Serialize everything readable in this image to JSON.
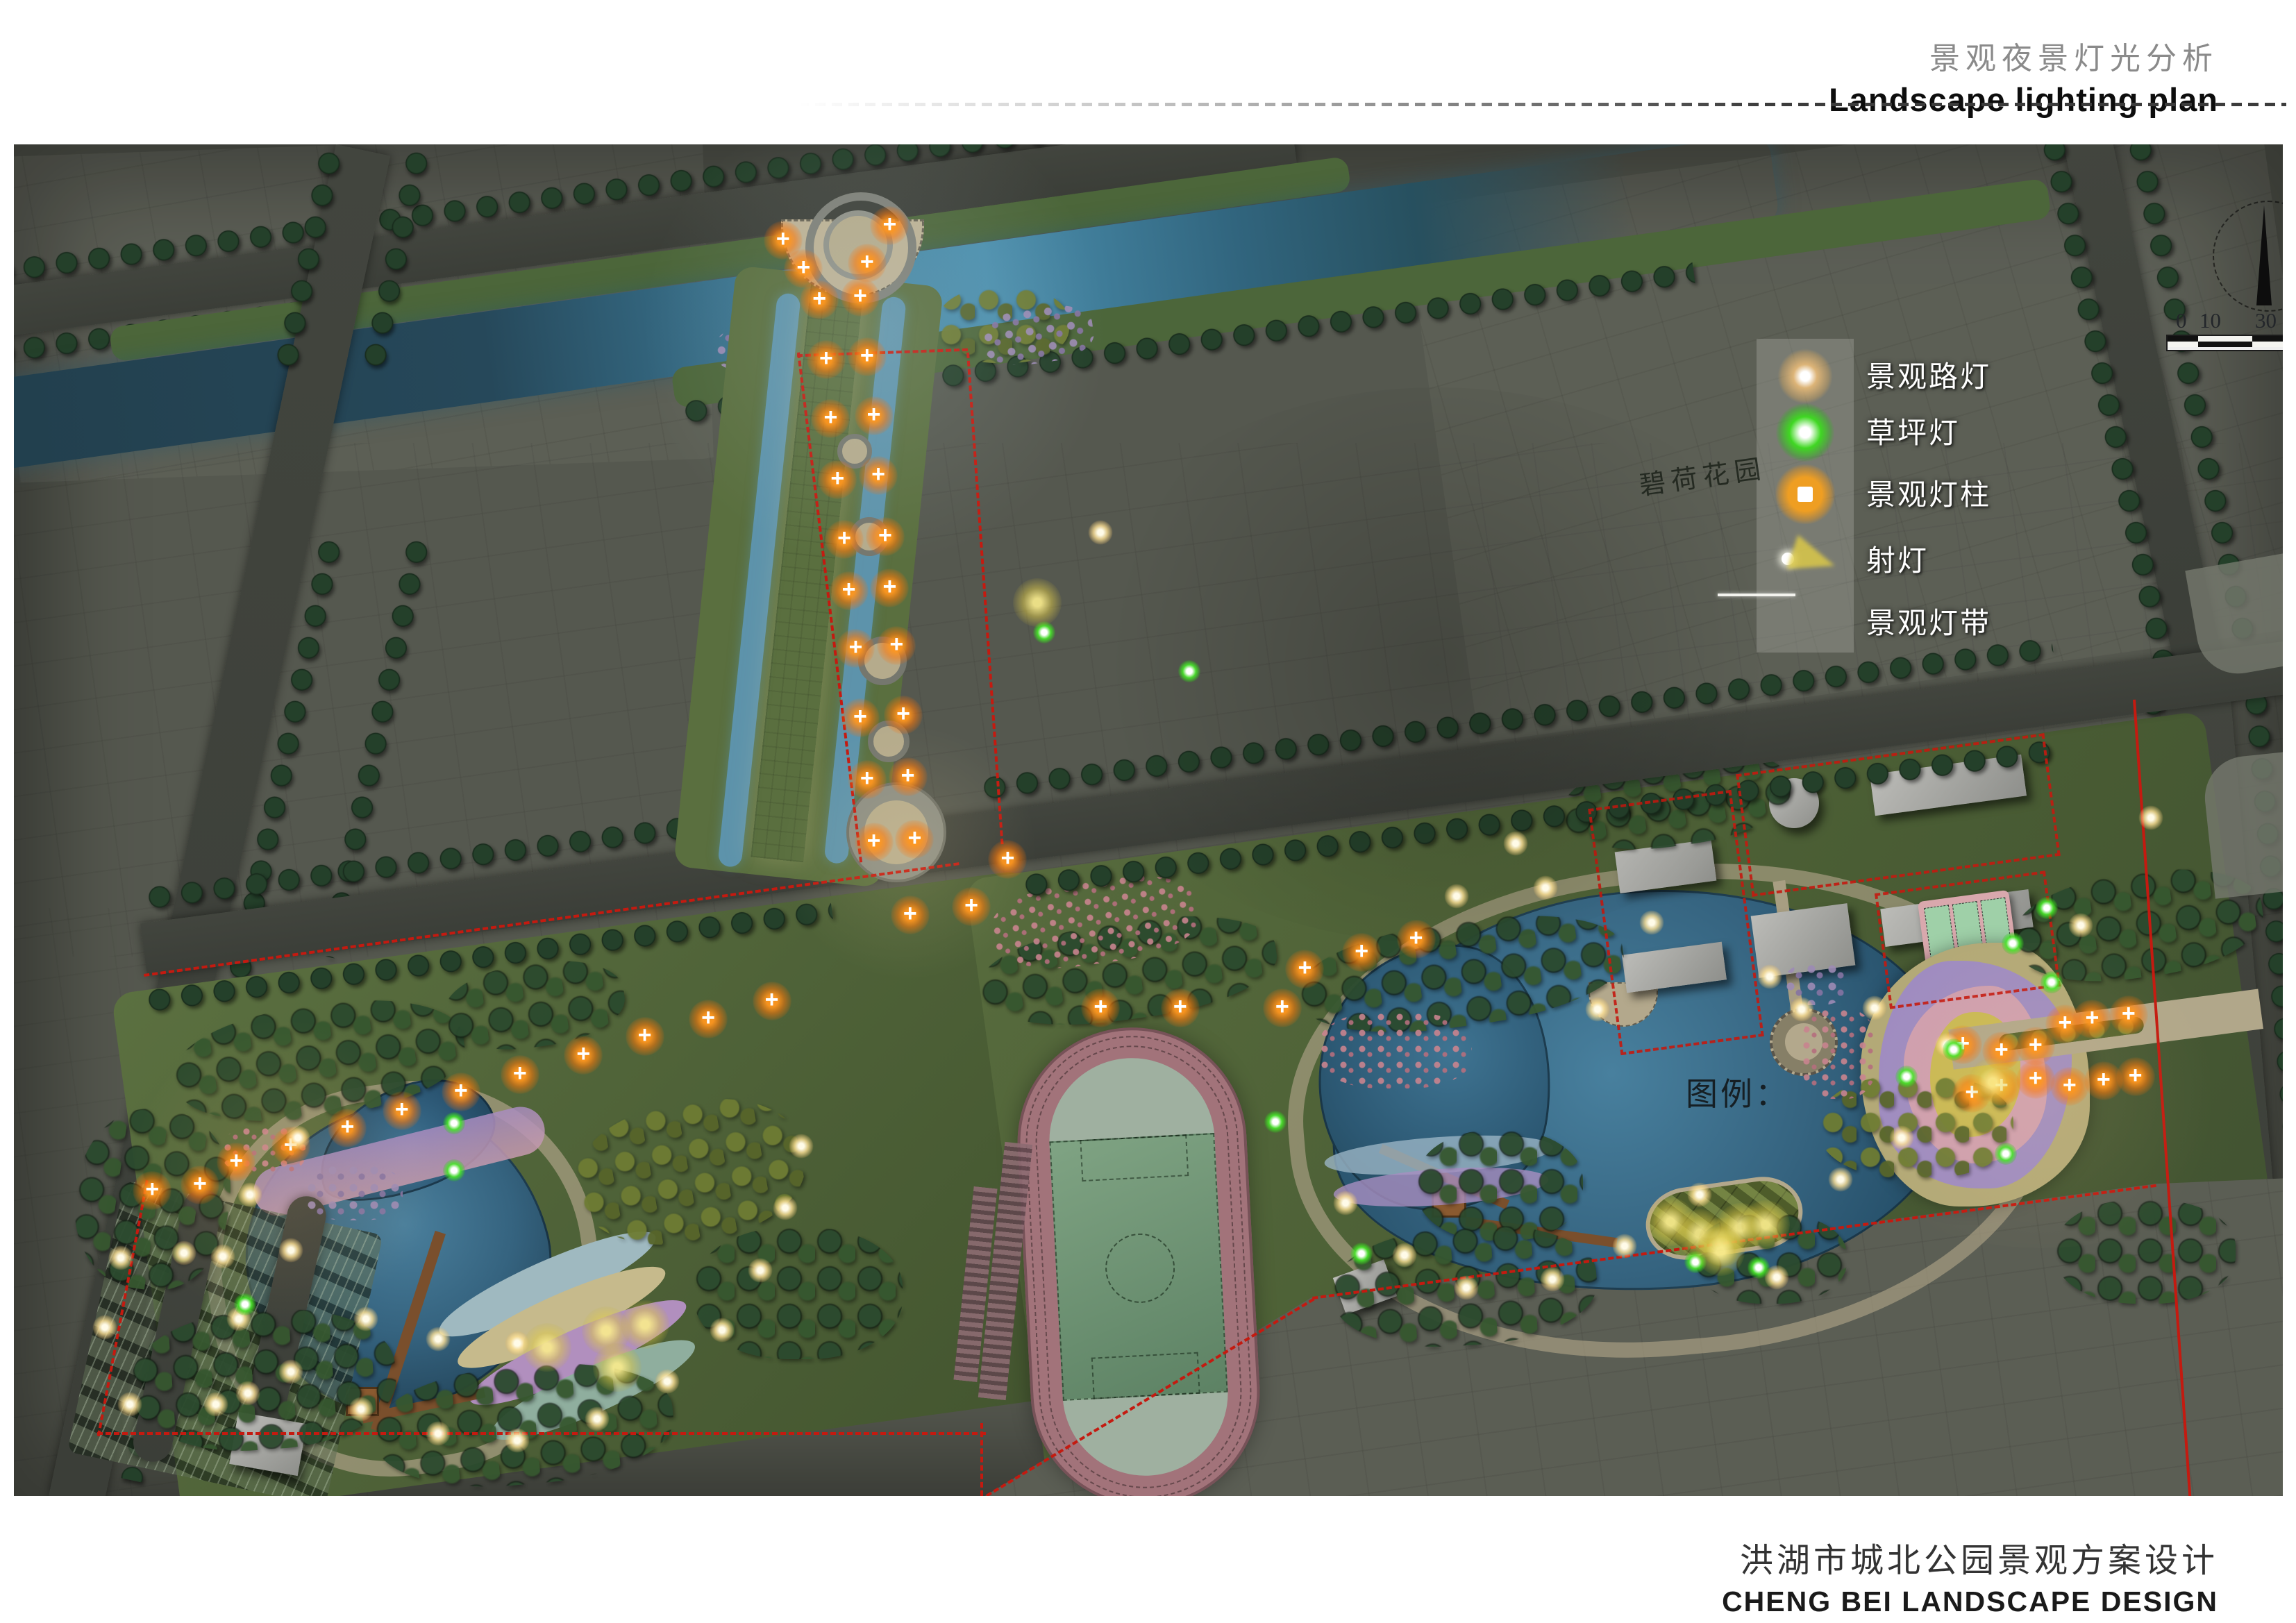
{
  "header": {
    "title_cn": "景观夜景灯光分析",
    "title_en": "Landscape lighting plan"
  },
  "footer": {
    "title_cn": "洪湖市城北公园景观方案设计",
    "title_en": "CHENG BEI  LANDSCAPE DESIGN"
  },
  "legend": {
    "pointer_label": "图例：",
    "items": [
      {
        "symbol": "road-light",
        "label": "景观路灯"
      },
      {
        "symbol": "lawn-light",
        "label": "草坪灯"
      },
      {
        "symbol": "light-column",
        "label": "景观灯柱"
      },
      {
        "symbol": "spot-light",
        "label": "射灯"
      },
      {
        "symbol": "light-strip",
        "label": "景观灯带"
      }
    ]
  },
  "map": {
    "estate_label": "碧荷花园",
    "scale_bar": {
      "labels": [
        "0",
        "10",
        "30"
      ]
    },
    "lights": [
      {
        "t": "o",
        "x": 33.9,
        "y": 7.1
      },
      {
        "t": "o",
        "x": 38.6,
        "y": 6.0
      },
      {
        "t": "o",
        "x": 34.8,
        "y": 9.2
      },
      {
        "t": "o",
        "x": 37.6,
        "y": 8.8
      },
      {
        "t": "o",
        "x": 35.5,
        "y": 11.5
      },
      {
        "t": "o",
        "x": 37.3,
        "y": 11.3
      },
      {
        "t": "o",
        "x": 35.8,
        "y": 15.9
      },
      {
        "t": "o",
        "x": 37.6,
        "y": 15.7
      },
      {
        "t": "o",
        "x": 36.0,
        "y": 20.3
      },
      {
        "t": "o",
        "x": 37.9,
        "y": 20.1
      },
      {
        "t": "o",
        "x": 36.3,
        "y": 24.8
      },
      {
        "t": "o",
        "x": 38.1,
        "y": 24.5
      },
      {
        "t": "o",
        "x": 36.6,
        "y": 29.2
      },
      {
        "t": "o",
        "x": 38.4,
        "y": 29.0
      },
      {
        "t": "o",
        "x": 36.8,
        "y": 33.0
      },
      {
        "t": "o",
        "x": 38.6,
        "y": 32.8
      },
      {
        "t": "o",
        "x": 37.1,
        "y": 37.3
      },
      {
        "t": "o",
        "x": 38.9,
        "y": 37.1
      },
      {
        "t": "o",
        "x": 37.3,
        "y": 42.4
      },
      {
        "t": "o",
        "x": 39.2,
        "y": 42.2
      },
      {
        "t": "o",
        "x": 37.6,
        "y": 47.0
      },
      {
        "t": "o",
        "x": 39.4,
        "y": 46.8
      },
      {
        "t": "o",
        "x": 37.9,
        "y": 51.6
      },
      {
        "t": "o",
        "x": 39.7,
        "y": 51.4
      },
      {
        "t": "o",
        "x": 39.5,
        "y": 57.0
      },
      {
        "t": "o",
        "x": 42.2,
        "y": 56.4
      },
      {
        "t": "o",
        "x": 43.8,
        "y": 52.9
      },
      {
        "t": "o",
        "x": 9.8,
        "y": 75.3
      },
      {
        "t": "o",
        "x": 12.2,
        "y": 74.1
      },
      {
        "t": "o",
        "x": 14.7,
        "y": 72.8
      },
      {
        "t": "o",
        "x": 17.1,
        "y": 71.5
      },
      {
        "t": "o",
        "x": 19.7,
        "y": 70.1
      },
      {
        "t": "o",
        "x": 22.3,
        "y": 68.8
      },
      {
        "t": "o",
        "x": 25.1,
        "y": 67.4
      },
      {
        "t": "o",
        "x": 27.8,
        "y": 66.0
      },
      {
        "t": "o",
        "x": 30.6,
        "y": 64.7
      },
      {
        "t": "o",
        "x": 33.4,
        "y": 63.4
      },
      {
        "t": "o",
        "x": 6.1,
        "y": 77.4
      },
      {
        "t": "o",
        "x": 8.2,
        "y": 77.0
      },
      {
        "t": "o",
        "x": 47.9,
        "y": 63.9
      },
      {
        "t": "o",
        "x": 51.4,
        "y": 63.9
      },
      {
        "t": "o",
        "x": 55.9,
        "y": 63.9
      },
      {
        "t": "o",
        "x": 56.9,
        "y": 61.0
      },
      {
        "t": "o",
        "x": 59.4,
        "y": 59.8
      },
      {
        "t": "o",
        "x": 61.8,
        "y": 58.8
      },
      {
        "t": "o",
        "x": 85.9,
        "y": 66.6
      },
      {
        "t": "o",
        "x": 87.6,
        "y": 67.1
      },
      {
        "t": "o",
        "x": 89.1,
        "y": 66.7
      },
      {
        "t": "o",
        "x": 90.4,
        "y": 65.1
      },
      {
        "t": "o",
        "x": 91.6,
        "y": 64.7
      },
      {
        "t": "o",
        "x": 93.2,
        "y": 64.4
      },
      {
        "t": "o",
        "x": 86.3,
        "y": 70.2
      },
      {
        "t": "o",
        "x": 87.6,
        "y": 69.7
      },
      {
        "t": "o",
        "x": 89.1,
        "y": 69.2
      },
      {
        "t": "o",
        "x": 90.6,
        "y": 69.7
      },
      {
        "t": "o",
        "x": 92.1,
        "y": 69.3
      },
      {
        "t": "o",
        "x": 93.5,
        "y": 69.0
      },
      {
        "t": "w",
        "x": 12.5,
        "y": 73.5
      },
      {
        "t": "w",
        "x": 10.4,
        "y": 77.7
      },
      {
        "t": "w",
        "x": 9.2,
        "y": 82.3
      },
      {
        "t": "w",
        "x": 9.9,
        "y": 86.9
      },
      {
        "t": "w",
        "x": 12.2,
        "y": 90.8
      },
      {
        "t": "w",
        "x": 15.3,
        "y": 93.6
      },
      {
        "t": "w",
        "x": 18.7,
        "y": 95.4
      },
      {
        "t": "w",
        "x": 22.2,
        "y": 95.9
      },
      {
        "t": "w",
        "x": 25.7,
        "y": 94.3
      },
      {
        "t": "w",
        "x": 28.8,
        "y": 91.5
      },
      {
        "t": "w",
        "x": 31.2,
        "y": 87.7
      },
      {
        "t": "w",
        "x": 32.9,
        "y": 83.3
      },
      {
        "t": "w",
        "x": 34.0,
        "y": 78.7
      },
      {
        "t": "w",
        "x": 34.7,
        "y": 74.1
      },
      {
        "t": "w",
        "x": 63.6,
        "y": 55.6
      },
      {
        "t": "w",
        "x": 67.5,
        "y": 55.0
      },
      {
        "t": "w",
        "x": 72.2,
        "y": 57.6
      },
      {
        "t": "w",
        "x": 77.4,
        "y": 61.6
      },
      {
        "t": "w",
        "x": 82.0,
        "y": 63.9
      },
      {
        "t": "w",
        "x": 85.2,
        "y": 66.6
      },
      {
        "t": "w",
        "x": 58.7,
        "y": 78.3
      },
      {
        "t": "w",
        "x": 61.3,
        "y": 82.2
      },
      {
        "t": "w",
        "x": 64.0,
        "y": 84.6
      },
      {
        "t": "w",
        "x": 67.8,
        "y": 84.0
      },
      {
        "t": "w",
        "x": 71.0,
        "y": 81.5
      },
      {
        "t": "w",
        "x": 74.3,
        "y": 77.7
      },
      {
        "t": "w",
        "x": 77.7,
        "y": 83.8
      },
      {
        "t": "w",
        "x": 80.5,
        "y": 76.6
      },
      {
        "t": "w",
        "x": 83.2,
        "y": 73.5
      },
      {
        "t": "w",
        "x": 78.8,
        "y": 64.0
      },
      {
        "t": "w",
        "x": 66.2,
        "y": 51.7
      },
      {
        "t": "w",
        "x": 69.8,
        "y": 64.0
      },
      {
        "t": "w",
        "x": 7.5,
        "y": 82.0
      },
      {
        "t": "w",
        "x": 4.7,
        "y": 82.4
      },
      {
        "t": "w",
        "x": 4.0,
        "y": 87.5
      },
      {
        "t": "w",
        "x": 5.1,
        "y": 93.2
      },
      {
        "t": "w",
        "x": 8.9,
        "y": 93.2
      },
      {
        "t": "w",
        "x": 12.2,
        "y": 81.8
      },
      {
        "t": "w",
        "x": 10.3,
        "y": 92.4
      },
      {
        "t": "w",
        "x": 15.5,
        "y": 86.9
      },
      {
        "t": "w",
        "x": 18.7,
        "y": 88.4
      },
      {
        "t": "w",
        "x": 22.2,
        "y": 88.7
      },
      {
        "t": "w",
        "x": 47.9,
        "y": 28.7
      },
      {
        "t": "w",
        "x": 91.1,
        "y": 57.8
      },
      {
        "t": "w",
        "x": 94.2,
        "y": 49.8
      },
      {
        "t": "g",
        "x": 19.4,
        "y": 72.4
      },
      {
        "t": "g",
        "x": 19.4,
        "y": 75.9
      },
      {
        "t": "g",
        "x": 10.2,
        "y": 85.8
      },
      {
        "t": "g",
        "x": 55.6,
        "y": 72.3
      },
      {
        "t": "g",
        "x": 59.4,
        "y": 82.1
      },
      {
        "t": "g",
        "x": 74.1,
        "y": 82.7
      },
      {
        "t": "g",
        "x": 76.9,
        "y": 83.1
      },
      {
        "t": "g",
        "x": 89.6,
        "y": 56.5
      },
      {
        "t": "g",
        "x": 88.1,
        "y": 59.1
      },
      {
        "t": "g",
        "x": 89.8,
        "y": 62.0
      },
      {
        "t": "g",
        "x": 87.8,
        "y": 74.7
      },
      {
        "t": "g",
        "x": 85.5,
        "y": 67.0
      },
      {
        "t": "g",
        "x": 83.4,
        "y": 69.0
      },
      {
        "t": "g",
        "x": 45.4,
        "y": 36.1
      },
      {
        "t": "g",
        "x": 51.8,
        "y": 39.0
      },
      {
        "t": "y",
        "x": 23.5,
        "y": 89.0
      },
      {
        "t": "y",
        "x": 26.1,
        "y": 87.8
      },
      {
        "t": "y",
        "x": 26.6,
        "y": 90.5
      },
      {
        "t": "y",
        "x": 27.8,
        "y": 87.3
      },
      {
        "t": "y",
        "x": 73.0,
        "y": 79.7
      },
      {
        "t": "y",
        "x": 74.3,
        "y": 80.6
      },
      {
        "t": "y",
        "x": 75.3,
        "y": 81.2
      },
      {
        "t": "y",
        "x": 76.1,
        "y": 80.1
      },
      {
        "t": "y",
        "x": 77.2,
        "y": 79.9
      },
      {
        "t": "y",
        "x": 75.2,
        "y": 81.9
      },
      {
        "t": "y",
        "x": 45.1,
        "y": 33.9
      },
      {
        "t": "y",
        "x": 87.2,
        "y": 69.4
      }
    ]
  },
  "colors": {
    "accent_orange": "#ff8e12",
    "lawn_green": "#35d61e",
    "warm_light": "#ffe2a0",
    "spot_yellow": "#decA48",
    "boundary_red": "#c41a10",
    "river_blue": "#3f7f9e",
    "lake_blue": "#2e5f7f"
  }
}
